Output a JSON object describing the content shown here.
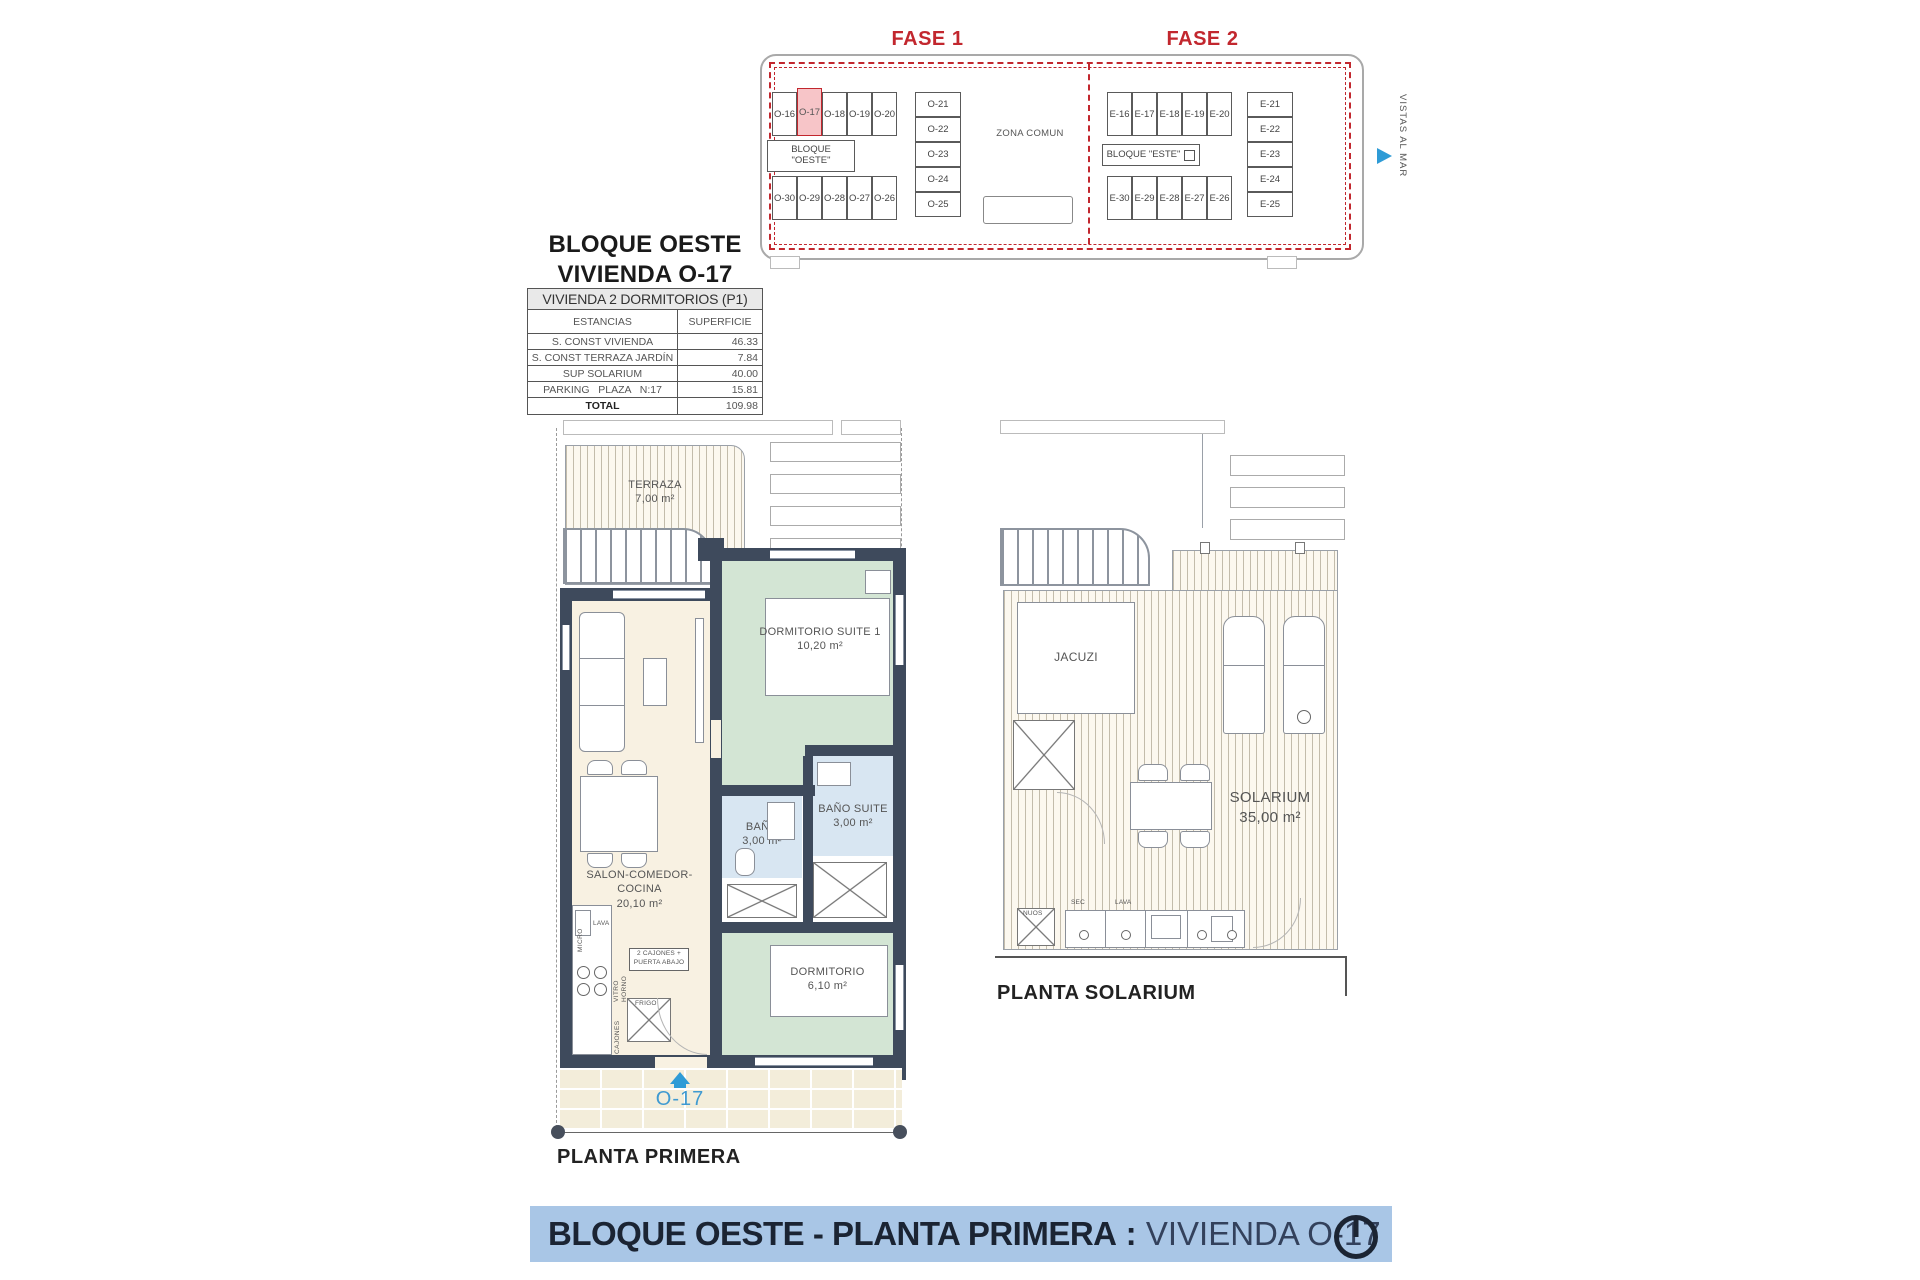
{
  "colors": {
    "accent_red": "#c2272e",
    "highlight_pink": "#f7c5c8",
    "wall_dark": "#3e4a5c",
    "room_green": "#d3e5d4",
    "room_cream": "#f8f1e2",
    "room_blue": "#d8e6f2",
    "banner_blue": "#a9c6e6",
    "unit_blue": "#3f9ad1",
    "text_dark": "#1d2433"
  },
  "site_plan": {
    "fase1": {
      "title": "FASE 1",
      "block_line1": "BLOQUE",
      "block_line2": "\"OESTE\"",
      "top_units": [
        "O-16",
        "O-17",
        "O-18",
        "O-19",
        "O-20"
      ],
      "bottom_units": [
        "O-30",
        "O-29",
        "O-28",
        "O-27",
        "O-26"
      ],
      "right_units": [
        "O-21",
        "O-22",
        "O-23",
        "O-24",
        "O-25"
      ],
      "zona_comun": "ZONA COMUN"
    },
    "fase2": {
      "title": "FASE 2",
      "block_label": "BLOQUE \"ESTE\"",
      "top_units": [
        "E-16",
        "E-17",
        "E-18",
        "E-19",
        "E-20"
      ],
      "bottom_units": [
        "E-30",
        "E-29",
        "E-28",
        "E-27",
        "E-26"
      ],
      "right_units": [
        "E-21",
        "E-22",
        "E-23",
        "E-24",
        "E-25"
      ]
    },
    "vistas_al_mar": "VISTAS AL MAR"
  },
  "header": {
    "line1": "BLOQUE OESTE",
    "line2": "VIVIENDA O-17"
  },
  "area_table": {
    "title": "VIVIENDA 2 DORMITORIOS (P1)",
    "col1": "ESTANCIAS",
    "col2": "SUPERFICIE",
    "rows": [
      {
        "label": "S. CONST VIVIENDA",
        "value": "46.33"
      },
      {
        "label": "S. CONST TERRAZA JARDÍN",
        "value": "7.84"
      },
      {
        "label": "SUP SOLARIUM",
        "value": "40.00"
      },
      {
        "label": "PARKING   PLAZA   N:17",
        "value": "15.81"
      }
    ],
    "total_label": "TOTAL",
    "total_value": "109.98"
  },
  "planta_primera": {
    "caption": "PLANTA PRIMERA",
    "unit_tag": "O-17",
    "terraza_name": "TERRAZA",
    "terraza_area": "7,00 m²",
    "suite_name": "DORMITORIO SUITE 1",
    "suite_area": "10,20 m²",
    "salon_name": "SALON-COMEDOR-COCINA",
    "salon_area": "20,10 m²",
    "bano_name": "BAÑO",
    "bano_area": "3,00 m²",
    "bano_suite_name": "BAÑO SUITE",
    "bano_suite_area": "3,00 m²",
    "dorm_name": "DORMITORIO",
    "dorm_area": "6,10 m²",
    "kitchen": {
      "micro": "MICRO",
      "lava": "LAVA",
      "vitro": "VITRO",
      "horno": "HORNO",
      "cajones": "CAJONES",
      "frigo": "FRIGO",
      "note_line1": "2 CAJONES +",
      "note_line2": "PUERTA ABAJO"
    }
  },
  "planta_solarium": {
    "caption": "PLANTA SOLARIUM",
    "jacuzi": "JACUZI",
    "solarium_name": "SOLARIUM",
    "solarium_area": "35,00 m²",
    "sec": "SEC",
    "lava": "LAVA",
    "nuos": "NUOS"
  },
  "footer": {
    "bold": "BLOQUE OESTE - PLANTA PRIMERA",
    "sep": " : ",
    "regular": "VIVIENDA O-17"
  }
}
